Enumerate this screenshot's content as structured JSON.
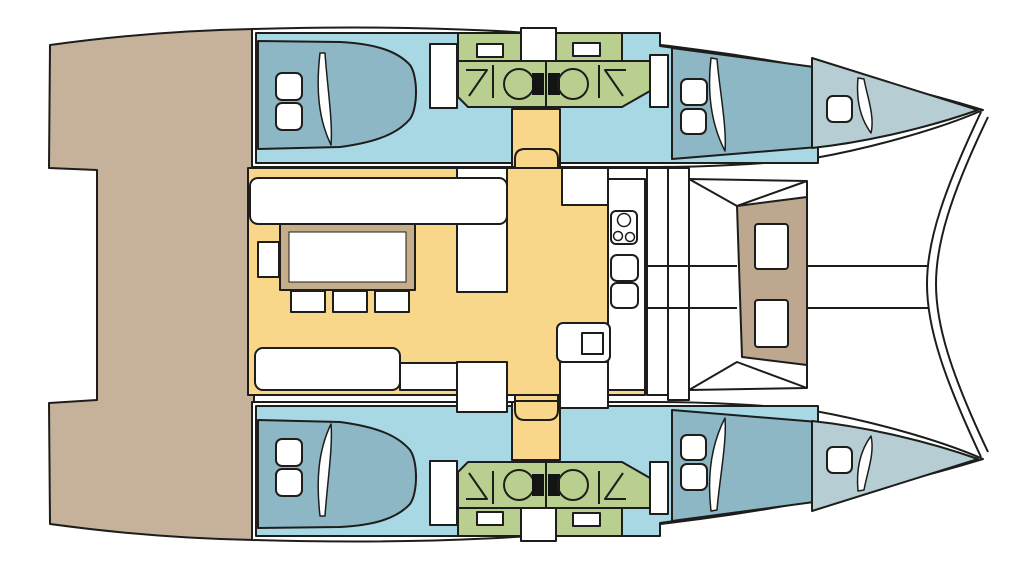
{
  "diagram": {
    "title": "catamaran-deck-plan",
    "colors": {
      "background": "#ffffff",
      "outline": "#1d1d1b",
      "hull_deck": "#ffffff",
      "aft_deck": "#c6b29b",
      "cabin_floor": "#a7d8e4",
      "bed": "#8db7c5",
      "forepeak_berth": "#b7cdd4",
      "bathroom": "#b9cf8f",
      "salon_floor": "#f8d78b",
      "cockpit_seat": "#bda88f",
      "table_border": "#c6ae8b",
      "furniture": "#ffffff",
      "toilet_tank": "#141414"
    },
    "areas": [
      {
        "name": "aft-deck",
        "color_key": "aft_deck"
      },
      {
        "name": "salon-and-galley",
        "color_key": "salon_floor"
      },
      {
        "name": "cabins",
        "color_key": "cabin_floor"
      },
      {
        "name": "beds",
        "color_key": "bed"
      },
      {
        "name": "bathrooms",
        "color_key": "bathroom"
      },
      {
        "name": "forward-cockpit-seat",
        "color_key": "cockpit_seat"
      },
      {
        "name": "forepeak-berths",
        "color_key": "forepeak_berth"
      }
    ],
    "features": {
      "double_cabins": 4,
      "bathrooms": 4,
      "toilets": 4,
      "showers": 4,
      "staircases": 2,
      "galley_burners": 3,
      "galley_sinks": 2,
      "dining_table_seats": 4,
      "forward_cockpit_tables": 2,
      "deck_hatches": 6
    }
  }
}
